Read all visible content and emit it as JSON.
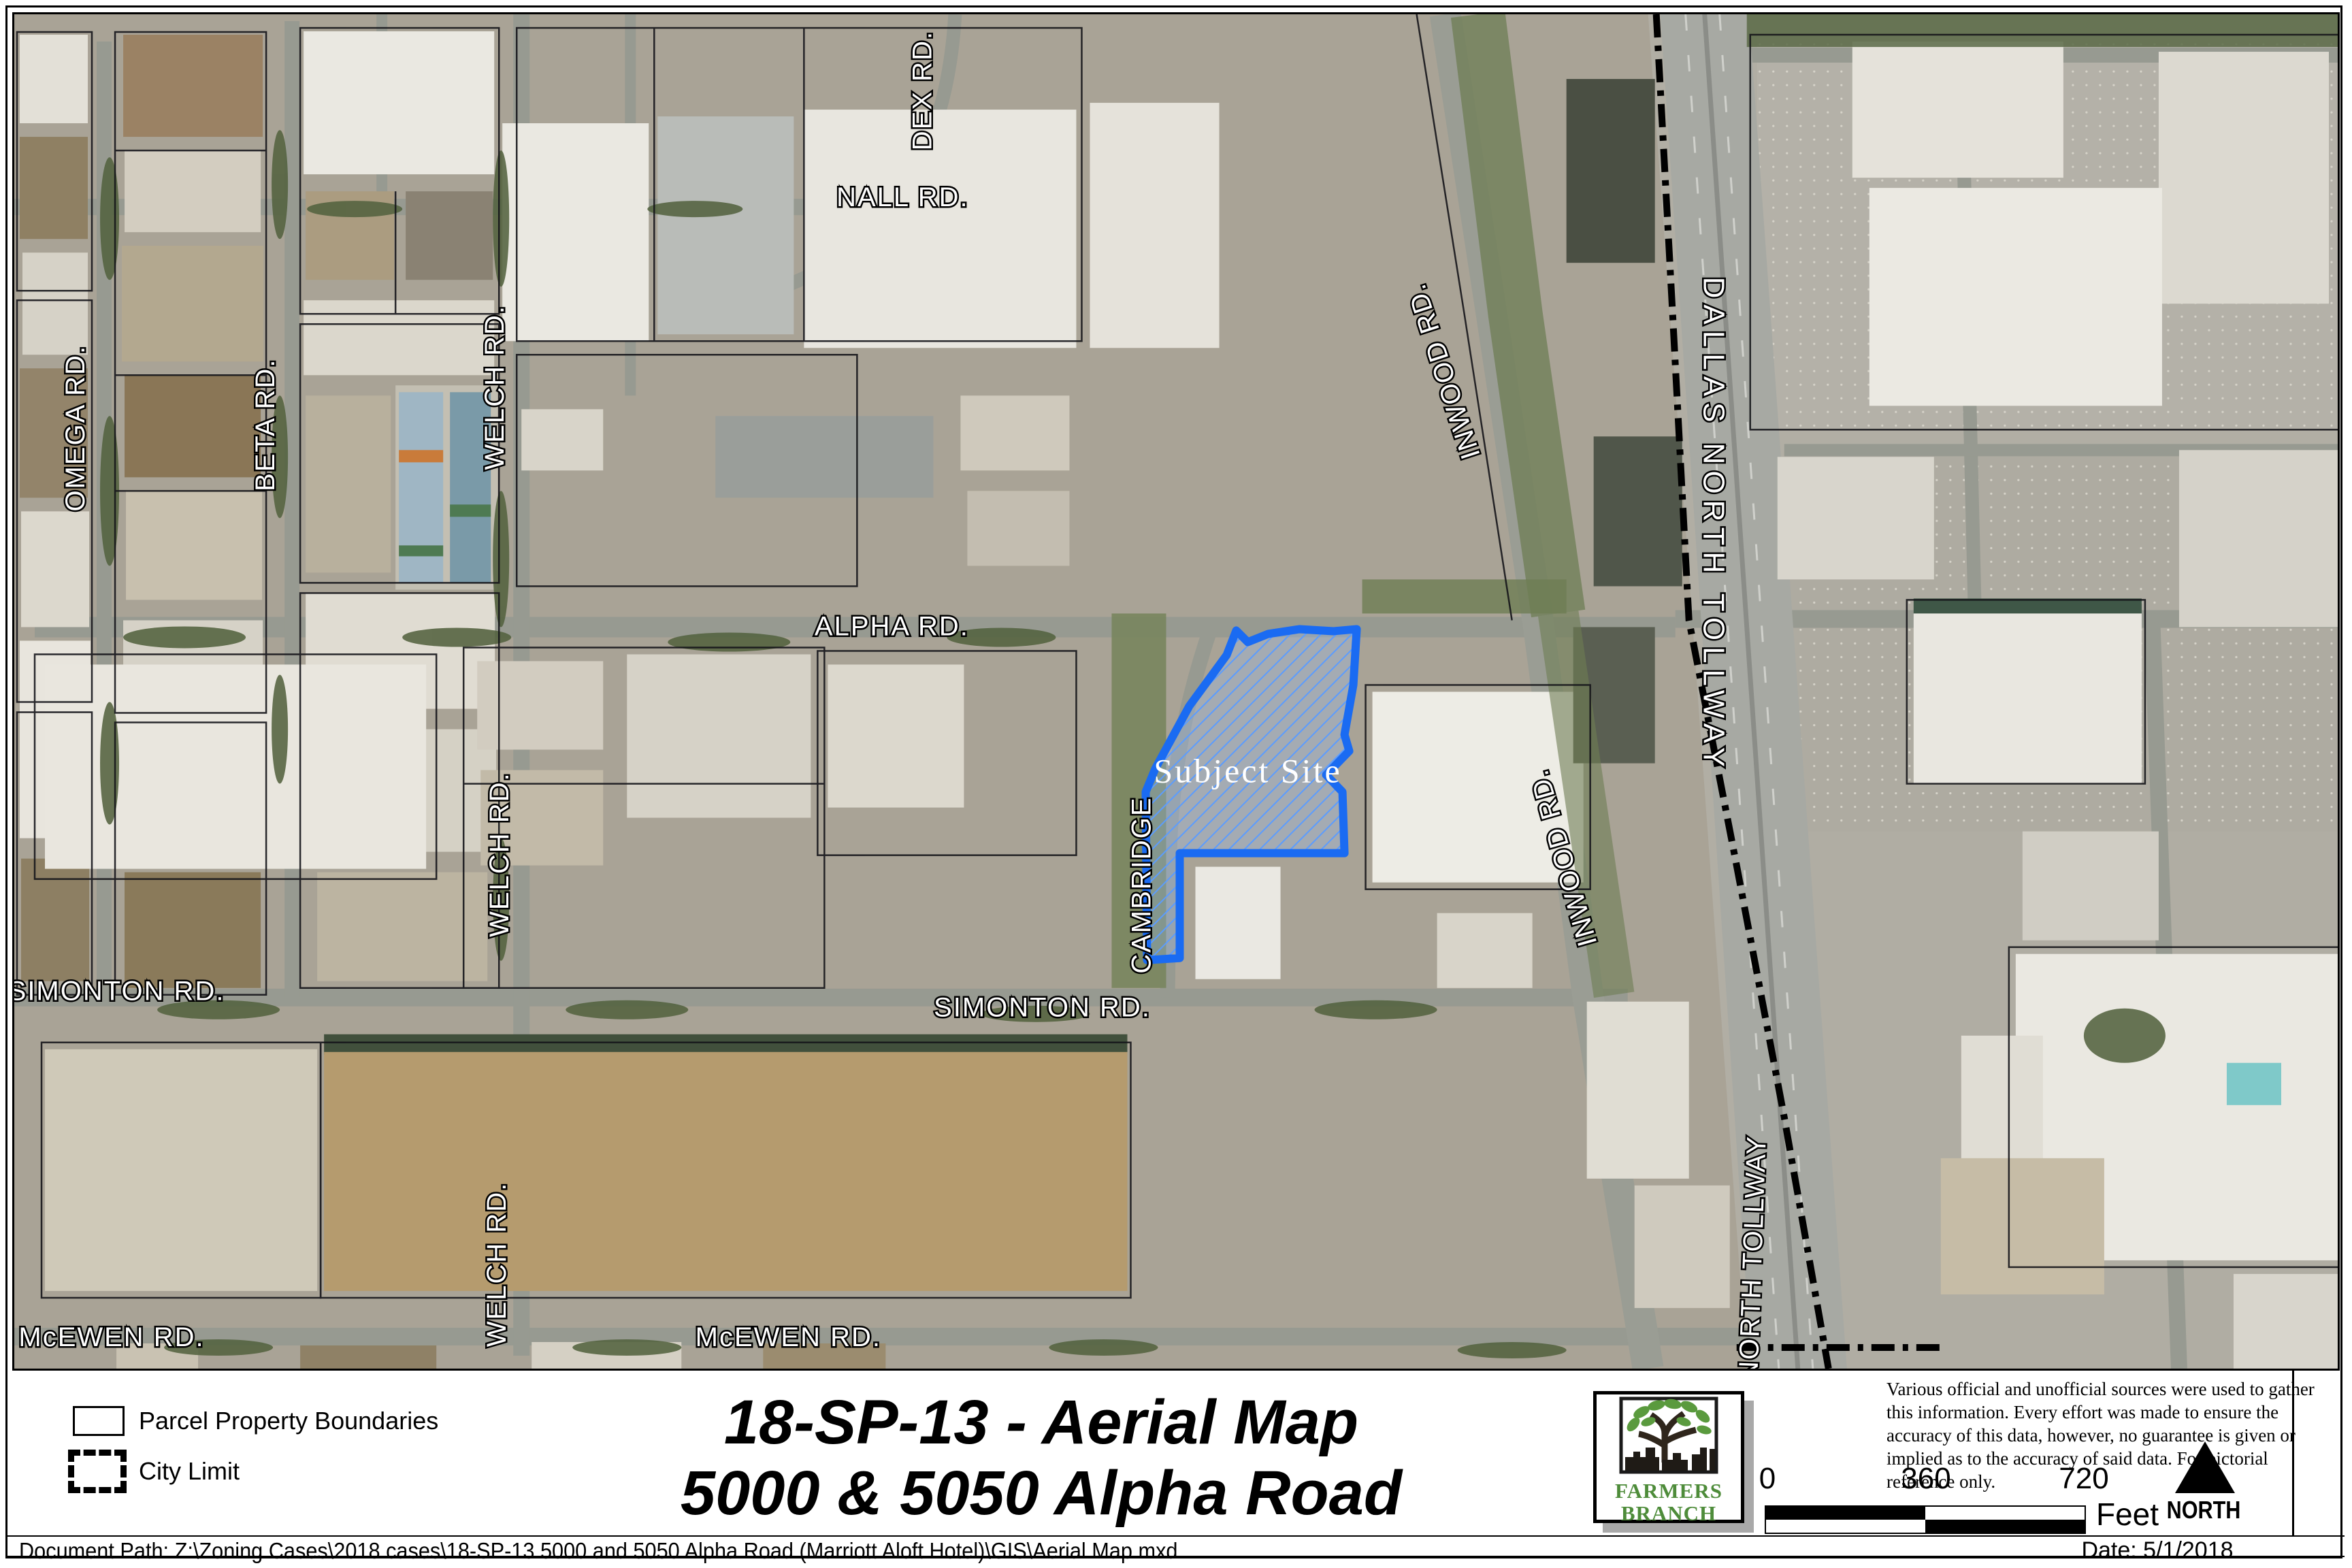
{
  "map": {
    "subject_site": {
      "label": "Subject Site",
      "outline_color": "#1a6bf2"
    },
    "road_labels": [
      {
        "id": "omega",
        "text": "OMEGA RD."
      },
      {
        "id": "beta",
        "text": "BETA RD."
      },
      {
        "id": "welch-north",
        "text": "WELCH RD."
      },
      {
        "id": "welch-mid",
        "text": "WELCH RD."
      },
      {
        "id": "welch-south",
        "text": "WELCH RD."
      },
      {
        "id": "dex",
        "text": "DEX RD."
      },
      {
        "id": "nall",
        "text": "NALL RD."
      },
      {
        "id": "alpha",
        "text": "ALPHA RD."
      },
      {
        "id": "simonton-west",
        "text": "SIMONTON RD."
      },
      {
        "id": "simonton-center",
        "text": "SIMONTON RD."
      },
      {
        "id": "mcewen-west",
        "text": "McEWEN RD."
      },
      {
        "id": "mcewen-center",
        "text": "McEWEN RD."
      },
      {
        "id": "cambridge",
        "text": "CAMBRIDGE"
      },
      {
        "id": "inwood-north",
        "text": "INWOOD RD."
      },
      {
        "id": "inwood-south",
        "text": "INWOOD RD."
      },
      {
        "id": "dallas-north-tollway",
        "text": "DALLAS NORTH TOLLWAY"
      },
      {
        "id": "tollway-south",
        "text": "S NORTH TOLLWAY"
      }
    ]
  },
  "legend": {
    "items": [
      {
        "label": "Parcel Property Boundaries"
      },
      {
        "label": "City Limit"
      }
    ]
  },
  "title": {
    "line1": "18-SP-13 - Aerial Map",
    "line2": "5000 & 5050 Alpha Road"
  },
  "logo": {
    "org_line1": "FARMERS",
    "org_line2": "BRANCH",
    "green": "#4e8c3a"
  },
  "disclaimer": "Various official and unofficial sources were used to gather this information. Every effort was made to ensure the accuracy of this data, however, no guarantee is given or implied as to the accuracy of said data.  For pictorial reference only.",
  "scale_bar": {
    "tick0": "0",
    "tick1": "360",
    "tick2": "720",
    "unit": "Feet"
  },
  "north_arrow": {
    "label": "NORTH"
  },
  "footer": {
    "document_path": "Document Path: Z:\\Zoning Cases\\2018 cases\\18-SP-13 5000 and 5050 Alpha Road (Marriott Aloft Hotel)\\GIS\\Aerial Map.mxd",
    "date": "Date: 5/1/2018"
  }
}
